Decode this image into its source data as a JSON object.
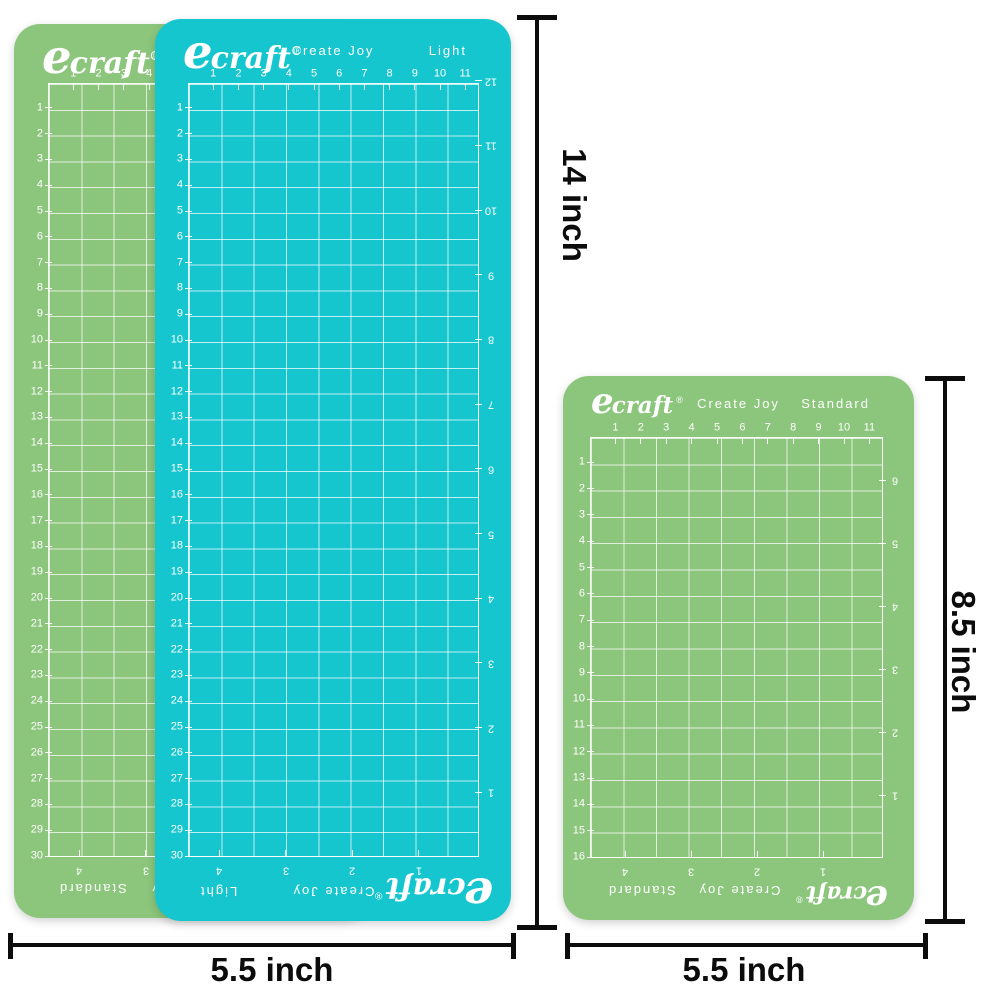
{
  "colors": {
    "teal_mat": "#16c6cf",
    "green_mat": "#8cc67c",
    "grid_line": "#ffffff",
    "dimension_ink": "#0c0c0c",
    "background": "#ffffff"
  },
  "mats": {
    "green_left": {
      "brand": "ecraft",
      "registered_mark": "®",
      "tagline": "Create Joy",
      "variant": "Standard",
      "scales": {
        "top": [
          "1",
          "2",
          "3",
          "4",
          "5",
          "6",
          "7",
          "8",
          "9",
          "10",
          "11"
        ],
        "left": [
          "1",
          "2",
          "3",
          "4",
          "5",
          "6",
          "7",
          "8",
          "9",
          "10",
          "11",
          "12",
          "13",
          "14",
          "15",
          "16",
          "17",
          "18",
          "19",
          "20",
          "21",
          "22",
          "23",
          "24",
          "25",
          "26",
          "27",
          "28",
          "29",
          "30"
        ],
        "right": [
          "12",
          "11",
          "10",
          "9",
          "8",
          "7",
          "6",
          "5",
          "4",
          "3",
          "2",
          "1"
        ],
        "bottom": [
          "4",
          "3",
          "2",
          "1"
        ]
      }
    },
    "teal": {
      "brand": "ecraft",
      "registered_mark": "®",
      "tagline": "Create Joy",
      "variant": "Light",
      "scales": {
        "top": [
          "1",
          "2",
          "3",
          "4",
          "5",
          "6",
          "7",
          "8",
          "9",
          "10",
          "11"
        ],
        "left": [
          "1",
          "2",
          "3",
          "4",
          "5",
          "6",
          "7",
          "8",
          "9",
          "10",
          "11",
          "12",
          "13",
          "14",
          "15",
          "16",
          "17",
          "18",
          "19",
          "20",
          "21",
          "22",
          "23",
          "24",
          "25",
          "26",
          "27",
          "28",
          "29",
          "30"
        ],
        "right": [
          "12",
          "11",
          "10",
          "9",
          "8",
          "7",
          "6",
          "5",
          "4",
          "3",
          "2",
          "1"
        ],
        "bottom": [
          "4",
          "3",
          "2",
          "1"
        ]
      }
    },
    "green_right": {
      "brand": "ecraft",
      "registered_mark": "®",
      "tagline": "Create Joy",
      "variant": "Standard",
      "scales": {
        "top": [
          "1",
          "2",
          "3",
          "4",
          "5",
          "6",
          "7",
          "8",
          "9",
          "10",
          "11"
        ],
        "left": [
          "1",
          "2",
          "3",
          "4",
          "5",
          "6",
          "7",
          "8",
          "9",
          "10",
          "11",
          "12",
          "13",
          "14",
          "15",
          "16"
        ],
        "right": [
          "6",
          "5",
          "4",
          "3",
          "2",
          "1"
        ],
        "bottom": [
          "4",
          "3",
          "2",
          "1"
        ]
      }
    }
  },
  "dimensions": {
    "left_mat_height": {
      "label": "14 inch"
    },
    "left_mat_width": {
      "label": "5.5 inch"
    },
    "right_mat_height": {
      "label": "8.5 inch"
    },
    "right_mat_width": {
      "label": "5.5 inch"
    }
  }
}
